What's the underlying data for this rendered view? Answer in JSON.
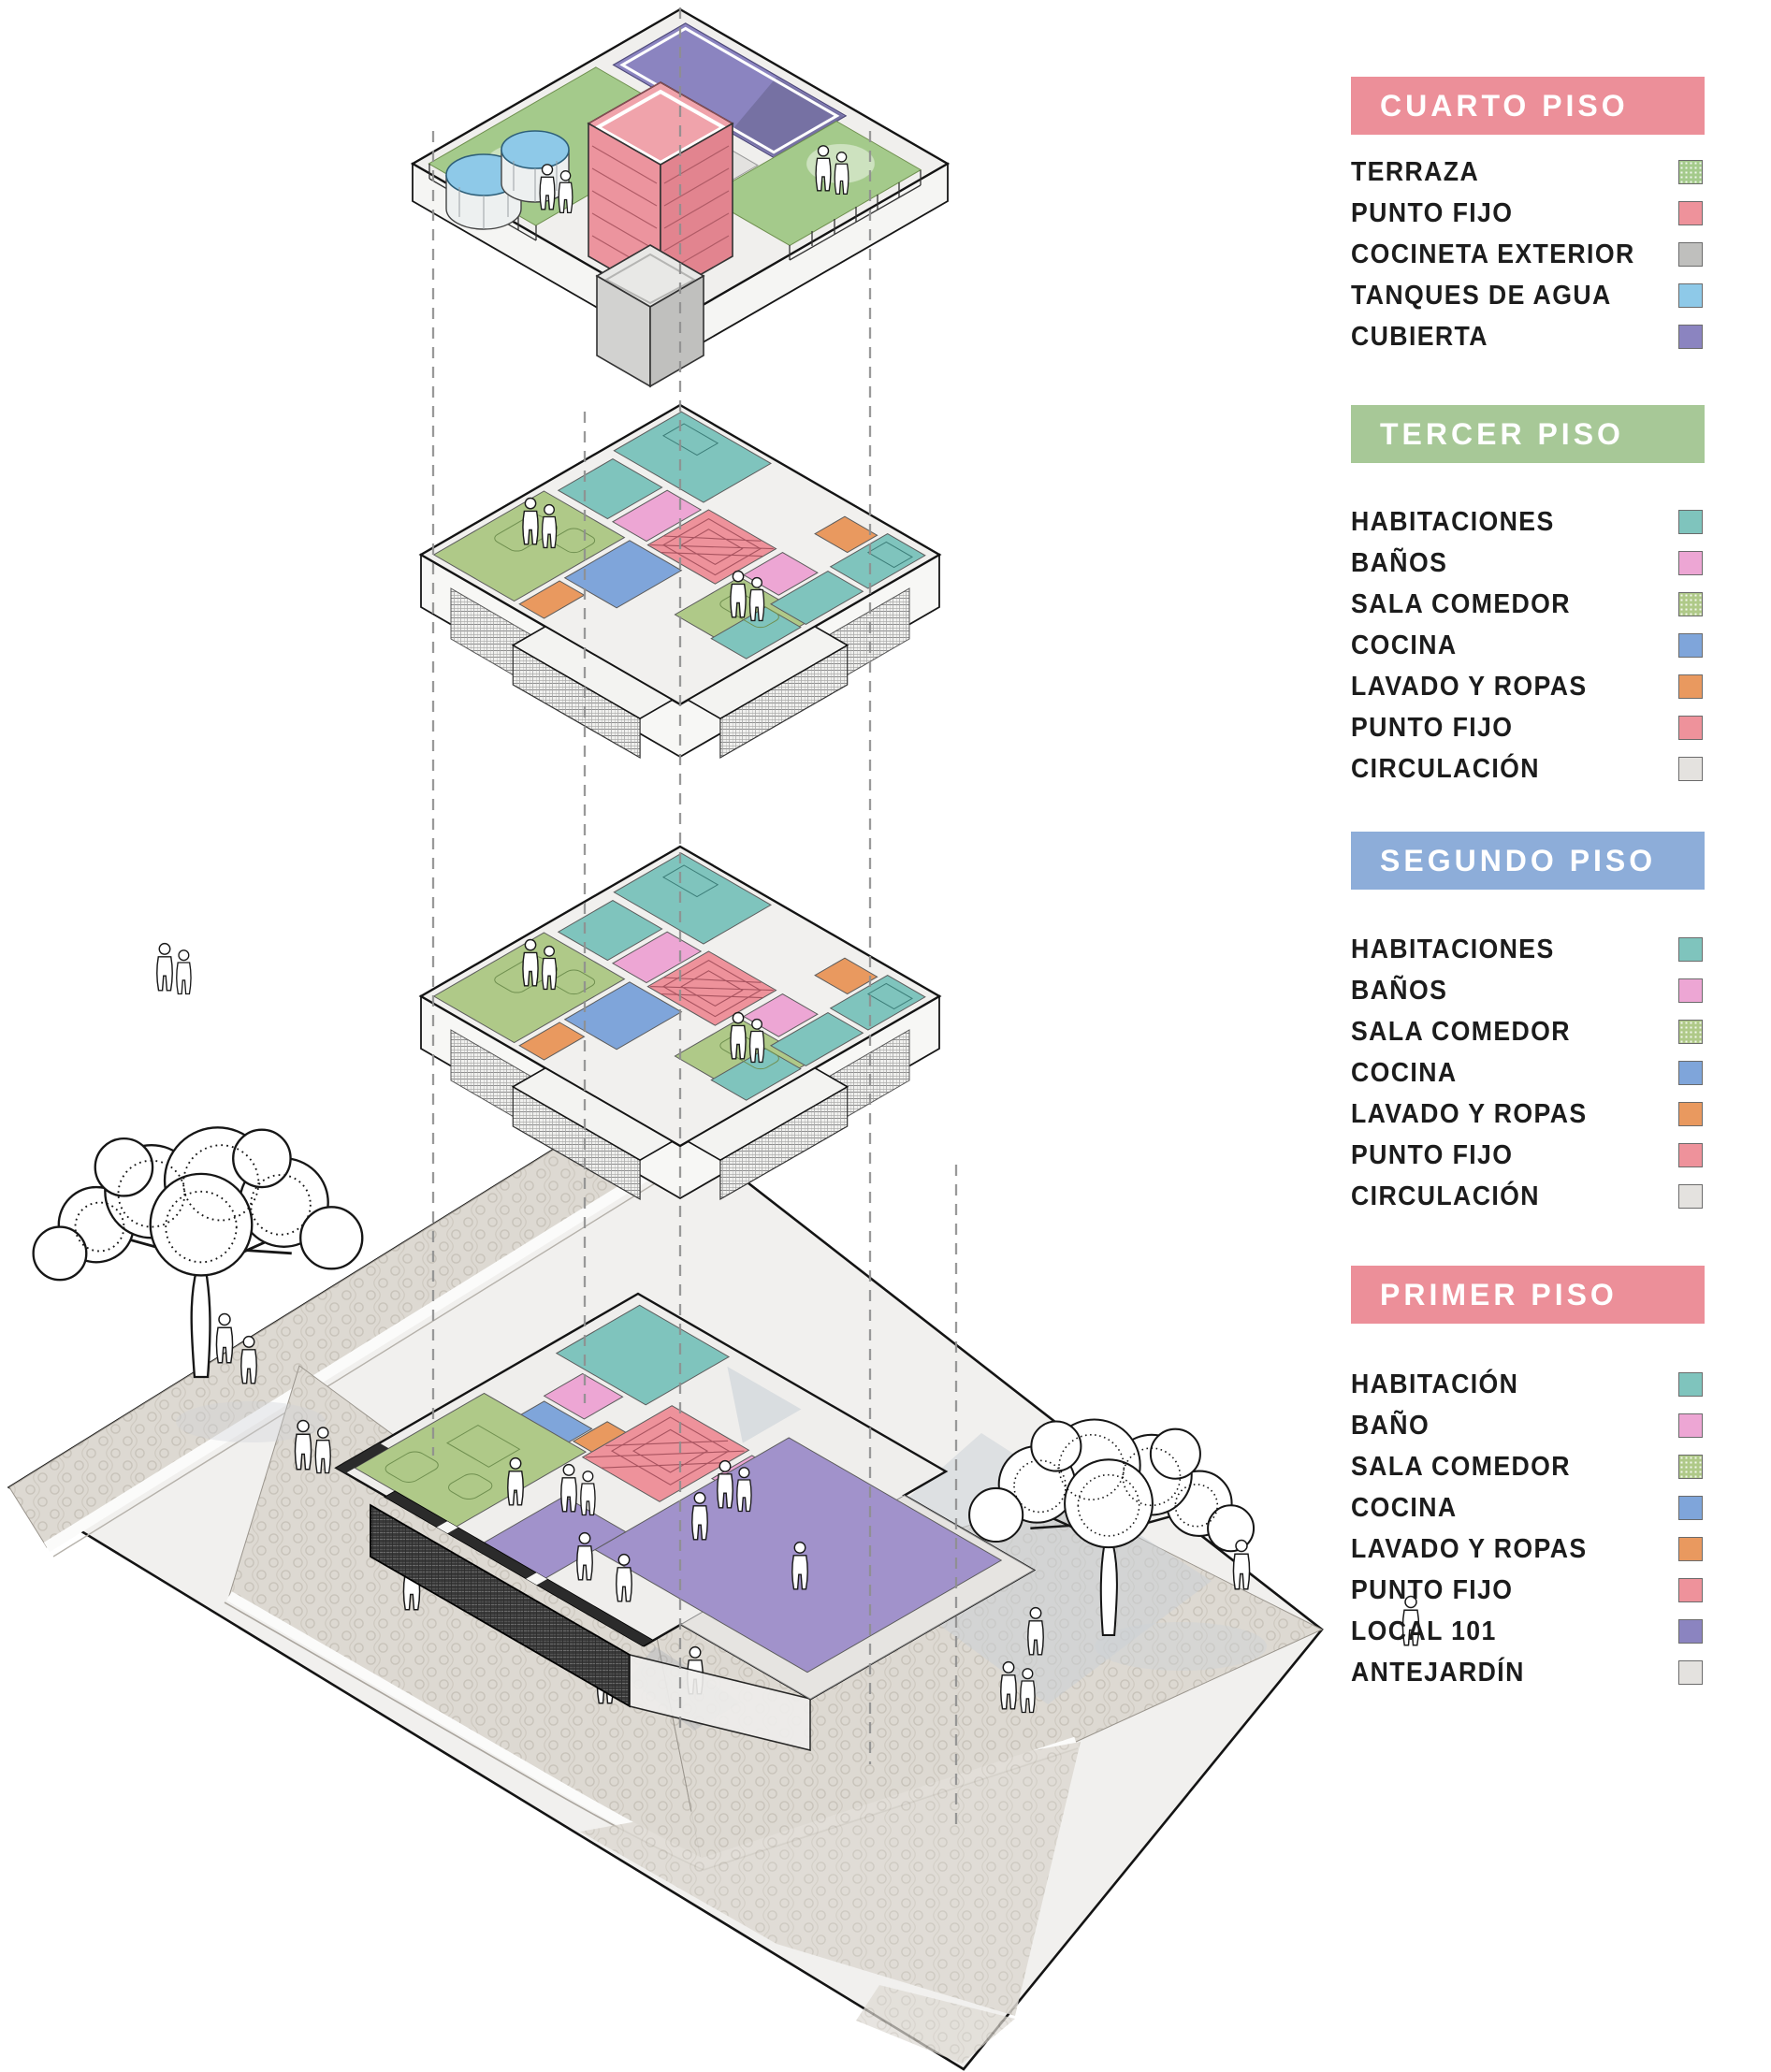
{
  "palette": {
    "habitaciones": "#7fc4bd",
    "banos": "#eda6d4",
    "sala_comedor": "#afc988",
    "cocina": "#7fa5da",
    "lavado_y_ropas": "#e9995f",
    "punto_fijo": "#ee929b",
    "circulacion": "#e4e2df",
    "terraza": "#a4ca8b",
    "cocineta_exterior": "#bfbfbd",
    "tanques_de_agua": "#8ec9e8",
    "cubierta": "#8b84c0",
    "local_101": "#a192cb",
    "antejardin": "#e6e4e1",
    "header_pink": "#ec8f99",
    "header_green": "#a7c897",
    "header_blue": "#8dadd9"
  },
  "legend": {
    "sections": [
      {
        "title": "CUARTO PISO",
        "header_color": "#ec8f99",
        "items": [
          {
            "label": "TERRAZA",
            "color": "#a4ca8b",
            "dotted": true
          },
          {
            "label": "PUNTO FIJO",
            "color": "#ee929b",
            "dotted": false
          },
          {
            "label": "COCINETA EXTERIOR",
            "color": "#bfbfbd",
            "dotted": false
          },
          {
            "label": "TANQUES DE AGUA",
            "color": "#8ec9e8",
            "dotted": false
          },
          {
            "label": "CUBIERTA",
            "color": "#8b84c0",
            "dotted": false
          }
        ]
      },
      {
        "title": "TERCER PISO",
        "header_color": "#a7c897",
        "items": [
          {
            "label": "HABITACIONES",
            "color": "#7fc4bd",
            "dotted": false
          },
          {
            "label": "BAÑOS",
            "color": "#eda6d4",
            "dotted": false
          },
          {
            "label": "SALA COMEDOR",
            "color": "#afc988",
            "dotted": true
          },
          {
            "label": "COCINA",
            "color": "#7fa5da",
            "dotted": false
          },
          {
            "label": "LAVADO Y ROPAS",
            "color": "#e9995f",
            "dotted": false
          },
          {
            "label": "PUNTO FIJO",
            "color": "#ee929b",
            "dotted": false
          },
          {
            "label": "CIRCULACIÓN",
            "color": "#e4e2df",
            "dotted": false
          }
        ]
      },
      {
        "title": "SEGUNDO PISO",
        "header_color": "#8dadd9",
        "items": [
          {
            "label": "HABITACIONES",
            "color": "#7fc4bd",
            "dotted": false
          },
          {
            "label": "BAÑOS",
            "color": "#eda6d4",
            "dotted": false
          },
          {
            "label": "SALA COMEDOR",
            "color": "#afc988",
            "dotted": true
          },
          {
            "label": "COCINA",
            "color": "#7fa5da",
            "dotted": false
          },
          {
            "label": "LAVADO Y ROPAS",
            "color": "#e9995f",
            "dotted": false
          },
          {
            "label": "PUNTO FIJO",
            "color": "#ee929b",
            "dotted": false
          },
          {
            "label": "CIRCULACIÓN",
            "color": "#e4e2df",
            "dotted": false
          }
        ]
      },
      {
        "title": "PRIMER PISO",
        "header_color": "#ec8f99",
        "items": [
          {
            "label": "HABITACIÓN",
            "color": "#7fc4bd",
            "dotted": false
          },
          {
            "label": "BAÑO",
            "color": "#eda6d4",
            "dotted": false
          },
          {
            "label": "SALA COMEDOR",
            "color": "#afc988",
            "dotted": true
          },
          {
            "label": "COCINA",
            "color": "#7fa5da",
            "dotted": false
          },
          {
            "label": "LAVADO Y ROPAS",
            "color": "#e9995f",
            "dotted": false
          },
          {
            "label": "PUNTO FIJO",
            "color": "#ee929b",
            "dotted": false
          },
          {
            "label": "LOCAL 101",
            "color": "#8b84c0",
            "dotted": false
          },
          {
            "label": "ANTEJARDÍN",
            "color": "#e4e2df",
            "dotted": false
          }
        ]
      }
    ]
  }
}
